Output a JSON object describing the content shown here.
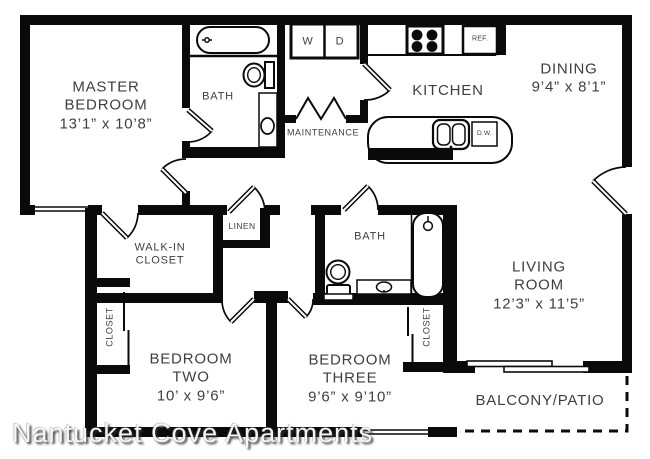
{
  "watermark": "Nantucket Cove Apartments",
  "colors": {
    "wall": "#0a0a0a",
    "text": "#3f3f3f",
    "background": "#ffffff"
  },
  "rooms": {
    "master_bedroom": {
      "line1": "MASTER",
      "line2": "BEDROOM",
      "dims": "13’1” x 10’8”"
    },
    "master_bath": {
      "label": "BATH"
    },
    "maintenance": {
      "label": "MAINTENANCE"
    },
    "kitchen": {
      "label": "KITCHEN"
    },
    "dining": {
      "label": "DINING",
      "dims": "9’4” x 8’1”"
    },
    "living_room": {
      "line1": "LIVING",
      "line2": "ROOM",
      "dims": "12’3” x 11’5”"
    },
    "walk_in_closet": {
      "line1": "WALK-IN",
      "line2": "CLOSET"
    },
    "linen": {
      "label": "LINEN"
    },
    "hall_bath": {
      "label": "BATH"
    },
    "bedroom_two": {
      "line1": "BEDROOM",
      "line2": "TWO",
      "dims": "10’ x 9’6”"
    },
    "bedroom_three": {
      "line1": "BEDROOM",
      "line2": "THREE",
      "dims": "9’6” x 9’10”"
    },
    "closet_bedroom_two": {
      "label": "CLOSET"
    },
    "closet_bedroom_three": {
      "label": "CLOSET"
    },
    "balcony": {
      "label": "BALCONY/PATIO"
    }
  },
  "appliances": {
    "washer": "W",
    "dryer": "D",
    "refrigerator": "REF.",
    "dishwasher": "D.W."
  }
}
